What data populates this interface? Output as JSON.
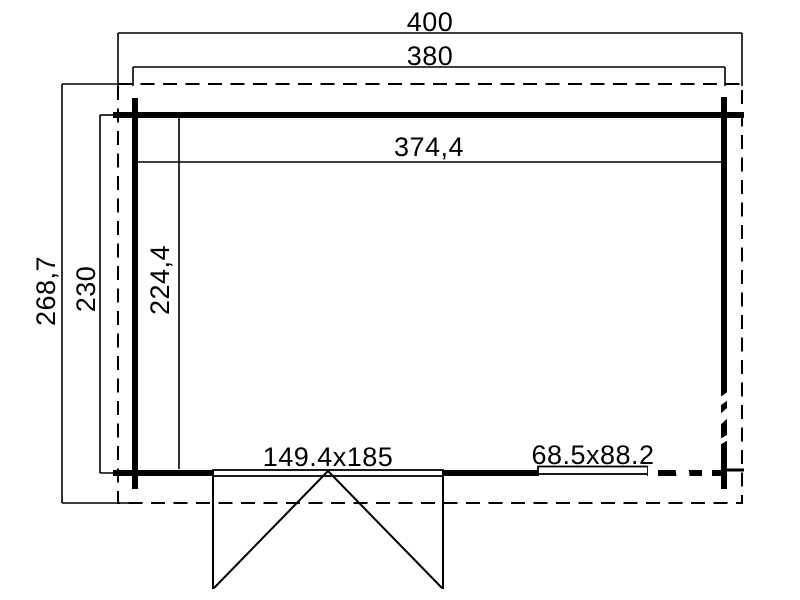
{
  "drawing_type": "floor-plan",
  "colors": {
    "background": "#ffffff",
    "line": "#000000"
  },
  "dims": {
    "overall_width": "400",
    "wall_outer_width": "380",
    "interior_width": "374,4",
    "overall_depth": "268,7",
    "wall_outer_depth": "230",
    "interior_depth": "224,4"
  },
  "openings": {
    "double_door": "149.4x185",
    "window": "68.5x88.2"
  }
}
